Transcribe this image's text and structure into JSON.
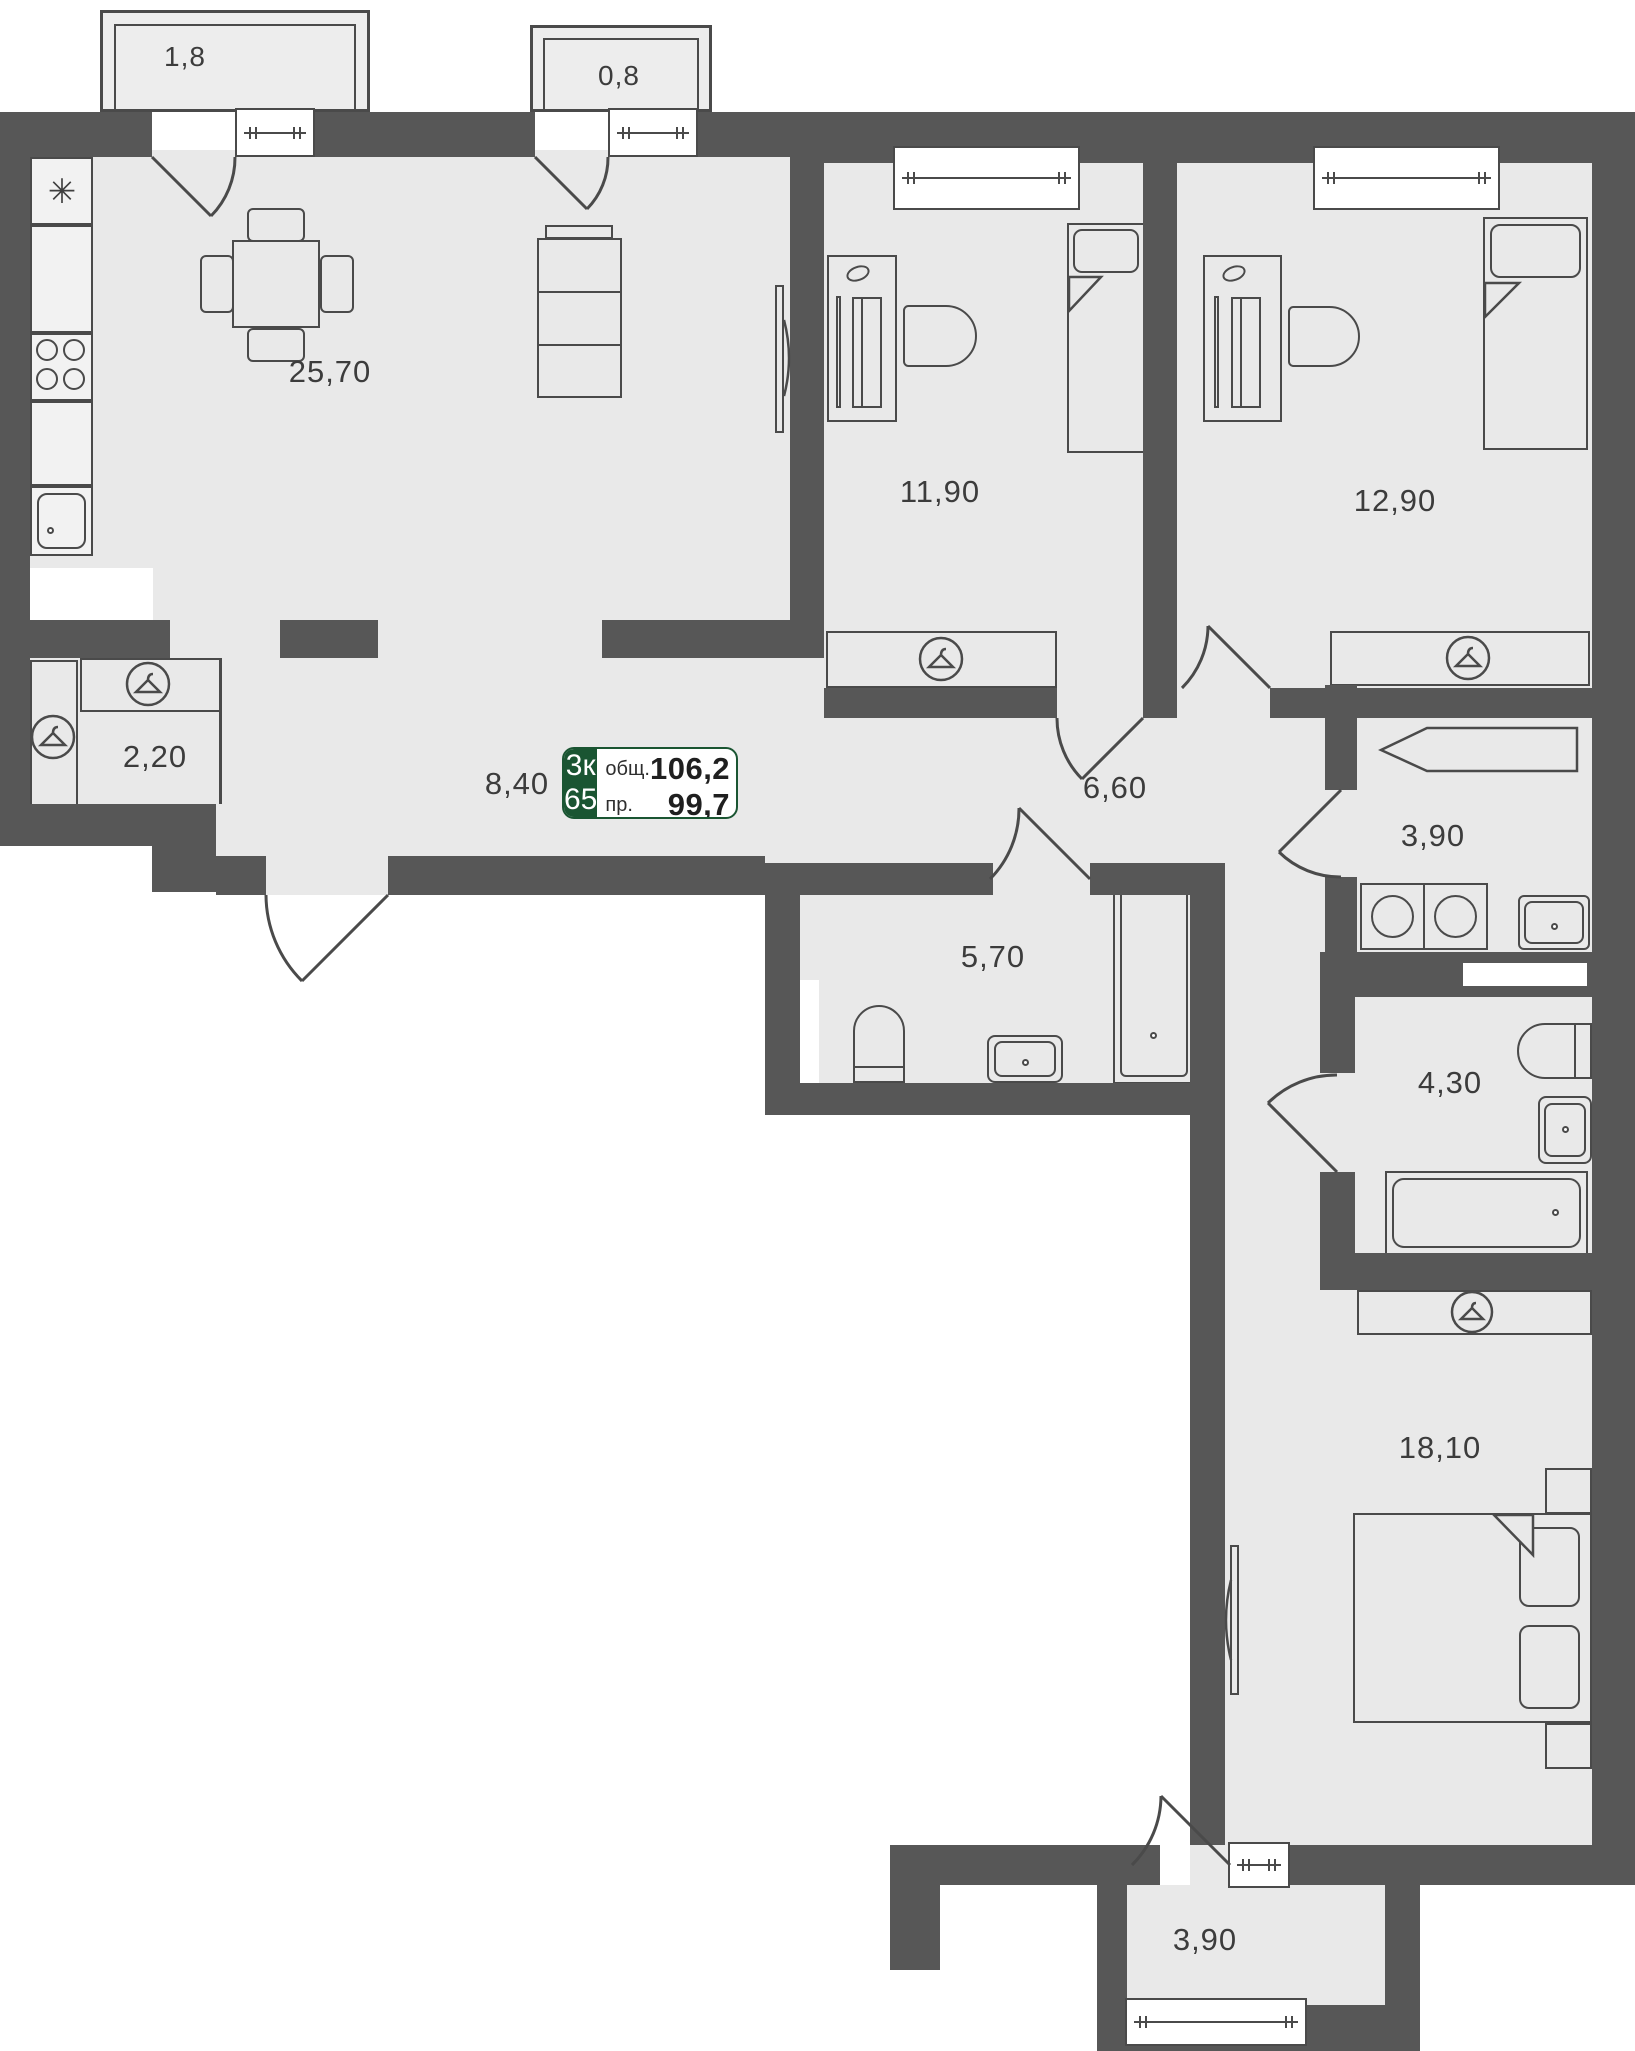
{
  "plan": {
    "badge": {
      "rooms_type": "3к",
      "unit": "65",
      "total_label": "общ.",
      "total_value": "106,2",
      "reduced_label": "пр.",
      "reduced_value": "99,7"
    },
    "rooms": {
      "balcony_top_left": {
        "area": "1,8"
      },
      "balcony_top_mid": {
        "area": "0,8"
      },
      "kitchen_living": {
        "area": "25,70"
      },
      "bedroom_1": {
        "area": "11,90"
      },
      "bedroom_2": {
        "area": "12,90"
      },
      "wardrobe": {
        "area": "2,20"
      },
      "hallway": {
        "area": "8,40"
      },
      "corridor": {
        "area": "6,60"
      },
      "bathroom_1": {
        "area": "5,70"
      },
      "laundry": {
        "area": "3,90"
      },
      "bathroom_2": {
        "area": "4,30"
      },
      "bedroom_3": {
        "area": "18,10"
      },
      "balcony_bottom": {
        "area": "3,90"
      }
    },
    "colors": {
      "wall": "#575757",
      "floor": "#e9e9e9",
      "outline": "#4a4a4a",
      "accent_green": "#1a5532",
      "label_text": "#3c3c3c"
    },
    "icons": {
      "wardrobe": "hanger-icon",
      "fridge": "snowflake-icon",
      "fridge_glyph": "✳"
    }
  }
}
